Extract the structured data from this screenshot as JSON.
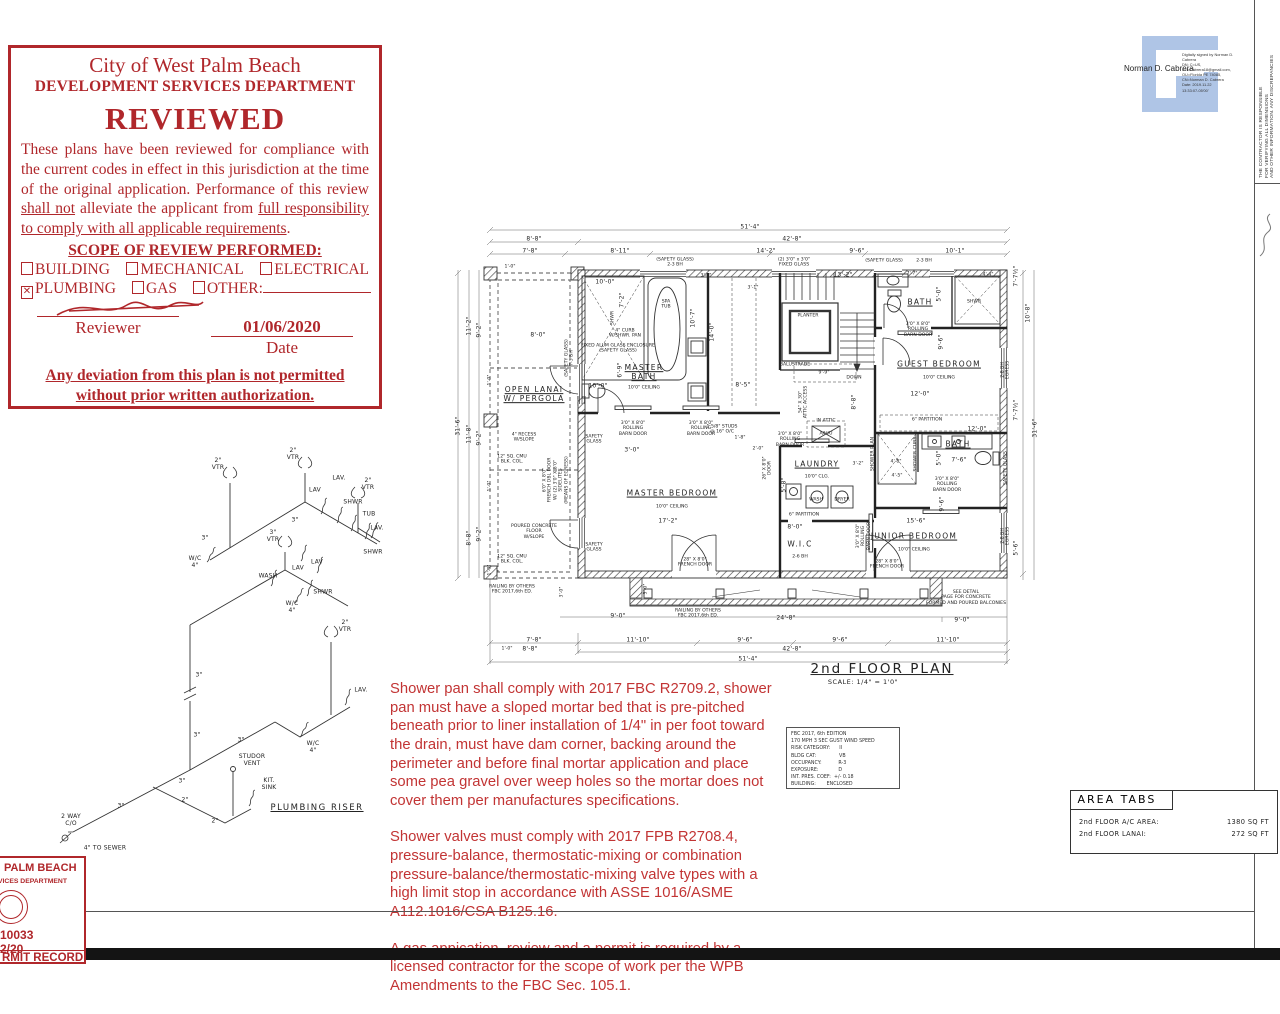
{
  "stamp": {
    "title": "City of West Palm Beach",
    "subtitle": "DEVELOPMENT SERVICES DEPARTMENT",
    "reviewed": "REVIEWED",
    "body": [
      {
        "t": "These plans have been reviewed for compliance with the current codes in effect in this jurisdiction at the time of the original application. Performance of this review "
      },
      {
        "t": "shall not",
        "u": true
      },
      {
        "t": " alleviate the applicant from "
      },
      {
        "t": "full responsibility to comply with all applicable requirements",
        "u": true
      },
      {
        "t": "."
      }
    ],
    "scope": {
      "title": "SCOPE OF REVIEW PERFORMED:",
      "rows": [
        [
          {
            "checked": false,
            "label": "BUILDING"
          },
          {
            "checked": false,
            "label": "MECHANICAL"
          },
          {
            "checked": false,
            "label": "ELECTRICAL"
          }
        ],
        [
          {
            "checked": true,
            "label": "PLUMBING"
          },
          {
            "checked": false,
            "label": "GAS"
          },
          {
            "checked": false,
            "label": "OTHER:",
            "line": true
          }
        ]
      ]
    },
    "date_value": "01/06/2020",
    "reviewer_label": "Reviewer",
    "date_label": "Date",
    "footer": "Any deviation from this plan is not permitted\nwithout prior written authorization.",
    "accent_color": "#b0272b"
  },
  "signature": {
    "name": "Norman D. Cabrera",
    "details": [
      "Digitally signed by Norman D.",
      "Cabrera",
      "DN: C=US,",
      "E=NCabrera18@gmail.com,",
      "OU=Florida PE 74085,",
      "CN=Norman D. Cabrera",
      "Date: 2019.11.22",
      "13:33:07-05'00'"
    ],
    "logo_color": "#afc5e6"
  },
  "contractor": {
    "lines": [
      "THE CONTRACTOR IS RESPONSIBLE",
      "FOR VERIFYING ALL DIMENSIONS",
      "AND OTHER INFORMATION. ANY DISCREPANCIES"
    ]
  },
  "wind_box": {
    "lines": [
      "FBC 2017, 6th EDITION",
      "170 MPH 3 SEC GUST WIND SPEED",
      "RISK CATEGORY:      II",
      "BLDG CAT:               VB",
      "OCCUPANCY:           R-3",
      "EXPOSURE:             D",
      "INT. PRES. COEF:  +/- 0.18",
      "BUILDING:       ENCLOSED"
    ]
  },
  "notes": {
    "paragraphs": [
      "Shower pan shall comply with 2017 FBC R2709.2, shower pan must have a sloped mortar bed that is pre-pitched beneath prior to liner installation of 1/4\" in  per foot toward the drain, must have dam corner, backing around the perimeter and before final mortar application and place some pea gravel over weep holes so the mortar does not cover them per manufactures specifications.",
      "Shower valves must comply with 2017 FPB R2708.4, pressure-balance, thermostatic-mixing or combination pressure-balance/thermostatic-mixing valve types with a high limit stop in accordance with ASSE 1016/ASME A112.1016/CSA B125.16.",
      "A gas appication, review and a permit is required by a licensed contractor for the scope of work per the WPB Amendments to the FBC Sec. 105.1."
    ],
    "color": "#c23434"
  },
  "area_tabs": {
    "title": "AREA TABS",
    "rows": [
      {
        "label": "2nd FLOOR A/C AREA:",
        "value": "1380 SQ FT"
      },
      {
        "label": "2nd FLOOR LANAI:",
        "value": "272 SQ FT"
      }
    ]
  },
  "permit": {
    "line1": "PALM BEACH",
    "line2": "VICES DEPARTMENT",
    "number": "10033",
    "date": "2/20",
    "footer": "RMIT RECORD"
  },
  "plan": {
    "labels": [
      {
        "t": "51'-4\"",
        "x": 300,
        "y": 9
      },
      {
        "t": "8'-8\"",
        "x": 84,
        "y": 21
      },
      {
        "t": "42'-8\"",
        "x": 342,
        "y": 21
      },
      {
        "t": "7'-8\"",
        "x": 80,
        "y": 33
      },
      {
        "t": "8'-11\"",
        "x": 170,
        "y": 33
      },
      {
        "t": "14'-2\"",
        "x": 316,
        "y": 33
      },
      {
        "t": "9'-6\"",
        "x": 407,
        "y": 33
      },
      {
        "t": "10'-1\"",
        "x": 505,
        "y": 33
      },
      {
        "t": "1'-0\"",
        "x": 60,
        "y": 49,
        "c": "tiny"
      },
      {
        "t": "(SAFETY GLASS)\n2-3 BH",
        "x": 225,
        "y": 45,
        "c": "tiny"
      },
      {
        "t": "(2) 3'0\" x 3'0\"\nFIXED GLASS",
        "x": 344,
        "y": 45,
        "c": "tiny"
      },
      {
        "t": "(SAFETY GLASS)",
        "x": 434,
        "y": 43,
        "c": "tiny"
      },
      {
        "t": "2-3 BH",
        "x": 474,
        "y": 43,
        "c": "tiny"
      },
      {
        "t": "31'-6\"",
        "x": 8,
        "y": 208,
        "r": -90
      },
      {
        "t": "11'-2\"",
        "x": 19,
        "y": 108,
        "r": -90
      },
      {
        "t": "9'-2\"",
        "x": 29,
        "y": 112,
        "r": -90
      },
      {
        "t": "11'-8\"",
        "x": 19,
        "y": 216,
        "r": -90
      },
      {
        "t": "9'-2\"",
        "x": 29,
        "y": 220,
        "r": -90
      },
      {
        "t": "8'-8\"",
        "x": 19,
        "y": 320,
        "r": -90
      },
      {
        "t": "9'-2\"",
        "x": 29,
        "y": 316,
        "r": -90
      },
      {
        "t": "1'-0\"",
        "x": 40,
        "y": 162,
        "r": -90,
        "c": "tiny"
      },
      {
        "t": "1'-0\"",
        "x": 40,
        "y": 268,
        "r": -90,
        "c": "tiny"
      },
      {
        "t": "1'-0\"",
        "x": 40,
        "y": 352,
        "r": -90,
        "c": "tiny"
      },
      {
        "t": "10'-8\"",
        "x": 578,
        "y": 95,
        "r": -90
      },
      {
        "t": "7'-7½\"",
        "x": 566,
        "y": 58,
        "r": -90
      },
      {
        "t": "7'-7½\"",
        "x": 566,
        "y": 192,
        "r": -90
      },
      {
        "t": "31'-6\"",
        "x": 585,
        "y": 210,
        "r": -90
      },
      {
        "t": "5'-6\"",
        "x": 566,
        "y": 330,
        "r": -90
      },
      {
        "t": "2-8 BH\nEGRESS",
        "x": 556,
        "y": 152,
        "r": -90,
        "c": "tiny"
      },
      {
        "t": "SAFETY GLASS",
        "x": 556,
        "y": 250,
        "r": -90,
        "c": "tiny"
      },
      {
        "t": "2-8 BH\nEGRESS",
        "x": 556,
        "y": 318,
        "r": -90,
        "c": "tiny"
      },
      {
        "t": "9'-0\"",
        "x": 168,
        "y": 398
      },
      {
        "t": "24'-8\"",
        "x": 336,
        "y": 400
      },
      {
        "t": "9'-0\"",
        "x": 512,
        "y": 402
      },
      {
        "t": "RAILING BY OTHERS\nFBC 2017,6th ED.",
        "x": 62,
        "y": 372,
        "c": "tiny"
      },
      {
        "t": "RAILING BY OTHERS\nFBC 2017,6th ED.",
        "x": 248,
        "y": 396,
        "c": "tiny"
      },
      {
        "t": "SEE DETAIL\nPAGE FOR CONCRETE\nFORMED AND POURED BALCONIES",
        "x": 516,
        "y": 380,
        "c": "tiny"
      },
      {
        "t": "3'-0\"",
        "x": 112,
        "y": 374,
        "r": -90,
        "c": "tiny"
      },
      {
        "t": "3'-0\"",
        "x": 196,
        "y": 371,
        "r": -90,
        "c": "tiny"
      },
      {
        "t": "7'-8\"",
        "x": 84,
        "y": 422
      },
      {
        "t": "11'-10\"",
        "x": 188,
        "y": 422
      },
      {
        "t": "9'-6\"",
        "x": 295,
        "y": 422
      },
      {
        "t": "9'-6\"",
        "x": 390,
        "y": 422
      },
      {
        "t": "11'-10\"",
        "x": 498,
        "y": 422
      },
      {
        "t": "1'-0\"",
        "x": 57,
        "y": 431,
        "c": "tiny"
      },
      {
        "t": "8'-8\"",
        "x": 80,
        "y": 431
      },
      {
        "t": "42'-8\"",
        "x": 342,
        "y": 431
      },
      {
        "t": "51'-4\"",
        "x": 298,
        "y": 441
      },
      {
        "t": "2nd FLOOR PLAN",
        "x": 432,
        "y": 452,
        "c": "title",
        "n": "plan-title"
      },
      {
        "t": "SCALE: 1/4\" = 1'0\"",
        "x": 413,
        "y": 465,
        "c": "scale",
        "n": "plan-scale"
      },
      {
        "t": "OPEN LANAI\nW/ PERGOLA",
        "x": 84,
        "y": 177,
        "c": "room",
        "u": 1
      },
      {
        "t": "MASTER\nBATH",
        "x": 194,
        "y": 155,
        "c": "room",
        "u": 1
      },
      {
        "t": "10'0\" CEILING",
        "x": 194,
        "y": 170,
        "c": "tiny"
      },
      {
        "t": "SPA\nTUB",
        "x": 216,
        "y": 87,
        "c": "tiny"
      },
      {
        "t": "MASTER BEDROOM",
        "x": 222,
        "y": 276,
        "c": "room",
        "u": 1
      },
      {
        "t": "10'0\" CEILING",
        "x": 222,
        "y": 289,
        "c": "tiny"
      },
      {
        "t": "17'-2\"",
        "x": 218,
        "y": 303
      },
      {
        "t": "PLANTER",
        "x": 358,
        "y": 98,
        "c": "tiny"
      },
      {
        "t": "DOWN",
        "x": 404,
        "y": 160,
        "c": "tiny"
      },
      {
        "t": "BALUSTRADE",
        "x": 345,
        "y": 147,
        "c": "tiny"
      },
      {
        "t": "BATH",
        "x": 470,
        "y": 85,
        "c": "room",
        "u": 1
      },
      {
        "t": "GUEST BEDROOM",
        "x": 489,
        "y": 147,
        "c": "room",
        "u": 1
      },
      {
        "t": "10'0\" CEILING",
        "x": 489,
        "y": 160,
        "c": "tiny"
      },
      {
        "t": "12'-0\"",
        "x": 470,
        "y": 176
      },
      {
        "t": "LAUNDRY",
        "x": 367,
        "y": 247,
        "c": "room",
        "u": 1
      },
      {
        "t": "10'0\" CLG.",
        "x": 367,
        "y": 259,
        "c": "tiny"
      },
      {
        "t": "WASH",
        "x": 366,
        "y": 282,
        "c": "tiny"
      },
      {
        "t": "DRYER",
        "x": 392,
        "y": 282,
        "c": "tiny"
      },
      {
        "t": "W.I.C",
        "x": 350,
        "y": 327,
        "c": "room"
      },
      {
        "t": "2-6 BH",
        "x": 350,
        "y": 339,
        "c": "tiny"
      },
      {
        "t": "BATH",
        "x": 508,
        "y": 227,
        "c": "room",
        "u": 1
      },
      {
        "t": "12'-0\"",
        "x": 527,
        "y": 211
      },
      {
        "t": "JUNIOR BEDROOM",
        "x": 464,
        "y": 319,
        "c": "room",
        "u": 1
      },
      {
        "t": "10'0\" CEILING",
        "x": 464,
        "y": 332,
        "c": "tiny"
      },
      {
        "t": "15'-6\"",
        "x": 466,
        "y": 303
      },
      {
        "t": "10'-0\"",
        "x": 155,
        "y": 64
      },
      {
        "t": "7'-2\"",
        "x": 172,
        "y": 82,
        "r": -90
      },
      {
        "t": "SHWR",
        "x": 163,
        "y": 100,
        "r": -90,
        "c": "tiny"
      },
      {
        "t": "4\" CURB\nW/SHWR. PAN",
        "x": 175,
        "y": 116,
        "c": "tiny"
      },
      {
        "t": "FIXED ALUM GLASS ENCLOSURE\n(SAFETY GLASS)",
        "x": 168,
        "y": 131,
        "c": "tiny"
      },
      {
        "t": "10'-0\"",
        "x": 148,
        "y": 168
      },
      {
        "t": "6'-9\"",
        "x": 170,
        "y": 152,
        "r": -90
      },
      {
        "t": "8'-0\"",
        "x": 88,
        "y": 117
      },
      {
        "t": "14'-0\"",
        "x": 262,
        "y": 114,
        "r": -90
      },
      {
        "t": "10'-7\"",
        "x": 243,
        "y": 100,
        "r": -90
      },
      {
        "t": "8'-5\"",
        "x": 293,
        "y": 167
      },
      {
        "t": "13'-2\"",
        "x": 393,
        "y": 57
      },
      {
        "t": "3'-0\"",
        "x": 256,
        "y": 58,
        "c": "tiny"
      },
      {
        "t": "3'-1\"",
        "x": 303,
        "y": 70,
        "c": "tiny"
      },
      {
        "t": "9'-9\"",
        "x": 374,
        "y": 155,
        "c": "tiny"
      },
      {
        "t": "8'-8\"",
        "x": 404,
        "y": 184,
        "r": -90
      },
      {
        "t": "54\" X 30\"\nATTIC ACCESS",
        "x": 354,
        "y": 184,
        "r": -90,
        "c": "tiny"
      },
      {
        "t": "IN ATTIC",
        "x": 376,
        "y": 203,
        "c": "tiny"
      },
      {
        "t": "A/H/U",
        "x": 376,
        "y": 216,
        "c": "tiny"
      },
      {
        "t": "1 5/8\" STUDS\n@ 16\" O/C",
        "x": 272,
        "y": 212,
        "c": "tiny"
      },
      {
        "t": "1'-8\"",
        "x": 290,
        "y": 220,
        "c": "tiny"
      },
      {
        "t": "2'-0\"",
        "x": 308,
        "y": 231,
        "c": "tiny"
      },
      {
        "t": "26\" X 8'0\"\nDOOR",
        "x": 318,
        "y": 250,
        "r": -90,
        "c": "tiny"
      },
      {
        "t": "3'-2\"",
        "x": 408,
        "y": 246,
        "c": "tiny"
      },
      {
        "t": "5'-8\"",
        "x": 334,
        "y": 267,
        "r": -90
      },
      {
        "t": "8'-0\"",
        "x": 345,
        "y": 309
      },
      {
        "t": "6\" PARTITION",
        "x": 354,
        "y": 297,
        "c": "tiny"
      },
      {
        "t": "6\" PARTITION",
        "x": 477,
        "y": 202,
        "c": "tiny"
      },
      {
        "t": "9'-6\"",
        "x": 491,
        "y": 124,
        "r": -90
      },
      {
        "t": "9'-6\"",
        "x": 492,
        "y": 286,
        "r": -90
      },
      {
        "t": "4'-8\"",
        "x": 446,
        "y": 244,
        "c": "tiny"
      },
      {
        "t": "5'-0\"",
        "x": 489,
        "y": 240,
        "r": -90
      },
      {
        "t": "7'-6\"",
        "x": 509,
        "y": 242
      },
      {
        "t": "4'-5\"",
        "x": 447,
        "y": 258,
        "c": "tiny"
      },
      {
        "t": "3'-0\"",
        "x": 182,
        "y": 232
      },
      {
        "t": "7'-7\"",
        "x": 462,
        "y": 56,
        "c": "tiny"
      },
      {
        "t": "4'-4\"",
        "x": 538,
        "y": 57,
        "c": "tiny"
      },
      {
        "t": "5'-0\"",
        "x": 489,
        "y": 76,
        "r": -90
      },
      {
        "t": "SHWR",
        "x": 524,
        "y": 84,
        "c": "tiny"
      },
      {
        "t": "SHOWER PLAN",
        "x": 423,
        "y": 236,
        "r": -90,
        "c": "tiny"
      },
      {
        "t": "SHOWER CURB",
        "x": 466,
        "y": 236,
        "r": -90,
        "c": "tiny"
      },
      {
        "t": "3'0\" X 8'0\"\nROLLING\nBARN DOOR",
        "x": 183,
        "y": 211,
        "c": "tiny"
      },
      {
        "t": "3'0\" X 8'0\"\nROLLING\nBARN DOOR",
        "x": 251,
        "y": 211,
        "c": "tiny"
      },
      {
        "t": "3'0\" X 8'0\"\nROLLING\nBARN DOOR",
        "x": 340,
        "y": 222,
        "c": "tiny"
      },
      {
        "t": "3'0\" X 8'0\"\nROLLING\nBARN DOOR",
        "x": 468,
        "y": 112,
        "c": "tiny"
      },
      {
        "t": "3'0\" X 8'0\"\nROLLING\nBARN DOOR",
        "x": 497,
        "y": 267,
        "c": "tiny"
      },
      {
        "t": "3'0\" X 8'0\"\nROLLING\nBARN DOOR",
        "x": 414,
        "y": 318,
        "r": -90,
        "c": "tiny"
      },
      {
        "t": "28\" X 8'0\"\nFRENCH DOOR",
        "x": 245,
        "y": 345,
        "c": "tiny"
      },
      {
        "t": "28\" X 8'0\"\nFRENCH DOOR",
        "x": 437,
        "y": 347,
        "c": "tiny"
      },
      {
        "t": "SAFETY\nGLASS",
        "x": 144,
        "y": 222,
        "c": "tiny"
      },
      {
        "t": "SAFETY\nGLASS",
        "x": 144,
        "y": 330,
        "c": "tiny"
      },
      {
        "t": "(SAFETY GLASS)\n7-3 BH",
        "x": 120,
        "y": 140,
        "r": -90,
        "c": "tiny"
      },
      {
        "t": "6'0\" X 8'0\"\nFRENCH DBL DOOR\nW/ (2) 3'0\" X 8'0\"\nSIDELITES\n(MEANS OF EGRESS)",
        "x": 106,
        "y": 262,
        "r": -90,
        "c": "tiny"
      },
      {
        "t": "4\" RECESS\nW/SLOPE",
        "x": 74,
        "y": 220,
        "c": "tiny"
      },
      {
        "t": "12\" SQ. CMU\nBLK. COL.",
        "x": 62,
        "y": 242,
        "c": "tiny"
      },
      {
        "t": "12\" SQ. CMU\nBLK. COL.",
        "x": 62,
        "y": 342,
        "c": "tiny"
      },
      {
        "t": "POURED CONCRETE\nFLOOR\nW/SLOPE",
        "x": 84,
        "y": 314,
        "c": "tiny"
      }
    ]
  },
  "riser": {
    "labels": [
      {
        "t": "2\"\nVTR",
        "x": 163,
        "y": 24
      },
      {
        "t": "2\"\nVTR",
        "x": 238,
        "y": 14
      },
      {
        "t": "2\"\nVTR",
        "x": 313,
        "y": 44
      },
      {
        "t": "3\"\nVTR",
        "x": 218,
        "y": 96
      },
      {
        "t": "2\"\nVTR",
        "x": 290,
        "y": 186
      },
      {
        "t": "LAV",
        "x": 260,
        "y": 50
      },
      {
        "t": "LAV.",
        "x": 284,
        "y": 38
      },
      {
        "t": "SHWR",
        "x": 298,
        "y": 62
      },
      {
        "t": "TUB",
        "x": 314,
        "y": 74
      },
      {
        "t": "LAV.",
        "x": 322,
        "y": 88
      },
      {
        "t": "SHWR",
        "x": 318,
        "y": 112
      },
      {
        "t": "W/C\n4\"",
        "x": 140,
        "y": 122
      },
      {
        "t": "3\"",
        "x": 150,
        "y": 98
      },
      {
        "t": "3\"",
        "x": 240,
        "y": 80
      },
      {
        "t": "LAV",
        "x": 243,
        "y": 128
      },
      {
        "t": "LAV",
        "x": 262,
        "y": 122
      },
      {
        "t": "WASH",
        "x": 213,
        "y": 136
      },
      {
        "t": "SHWR",
        "x": 268,
        "y": 152
      },
      {
        "t": "W/C\n4\"",
        "x": 237,
        "y": 167
      },
      {
        "t": "3\"",
        "x": 144,
        "y": 235
      },
      {
        "t": "3\"",
        "x": 142,
        "y": 295
      },
      {
        "t": "3\"",
        "x": 127,
        "y": 341
      },
      {
        "t": "3\"",
        "x": 186,
        "y": 300
      },
      {
        "t": "3\"",
        "x": 66,
        "y": 366
      },
      {
        "t": "2\"",
        "x": 130,
        "y": 360
      },
      {
        "t": "2\"",
        "x": 160,
        "y": 381
      },
      {
        "t": "STUDOR\nVENT",
        "x": 197,
        "y": 320
      },
      {
        "t": "KIT.\nSINK",
        "x": 214,
        "y": 344
      },
      {
        "t": "W/C\n4\"",
        "x": 258,
        "y": 307
      },
      {
        "t": "LAV.",
        "x": 306,
        "y": 250
      },
      {
        "t": "2 WAY\nC/O",
        "x": 16,
        "y": 380
      },
      {
        "t": "4\" TO SEWER",
        "x": 50,
        "y": 408
      },
      {
        "t": "PLUMBING RISER",
        "x": 262,
        "y": 368,
        "c": "rtitle",
        "n": "riser-title"
      }
    ]
  }
}
